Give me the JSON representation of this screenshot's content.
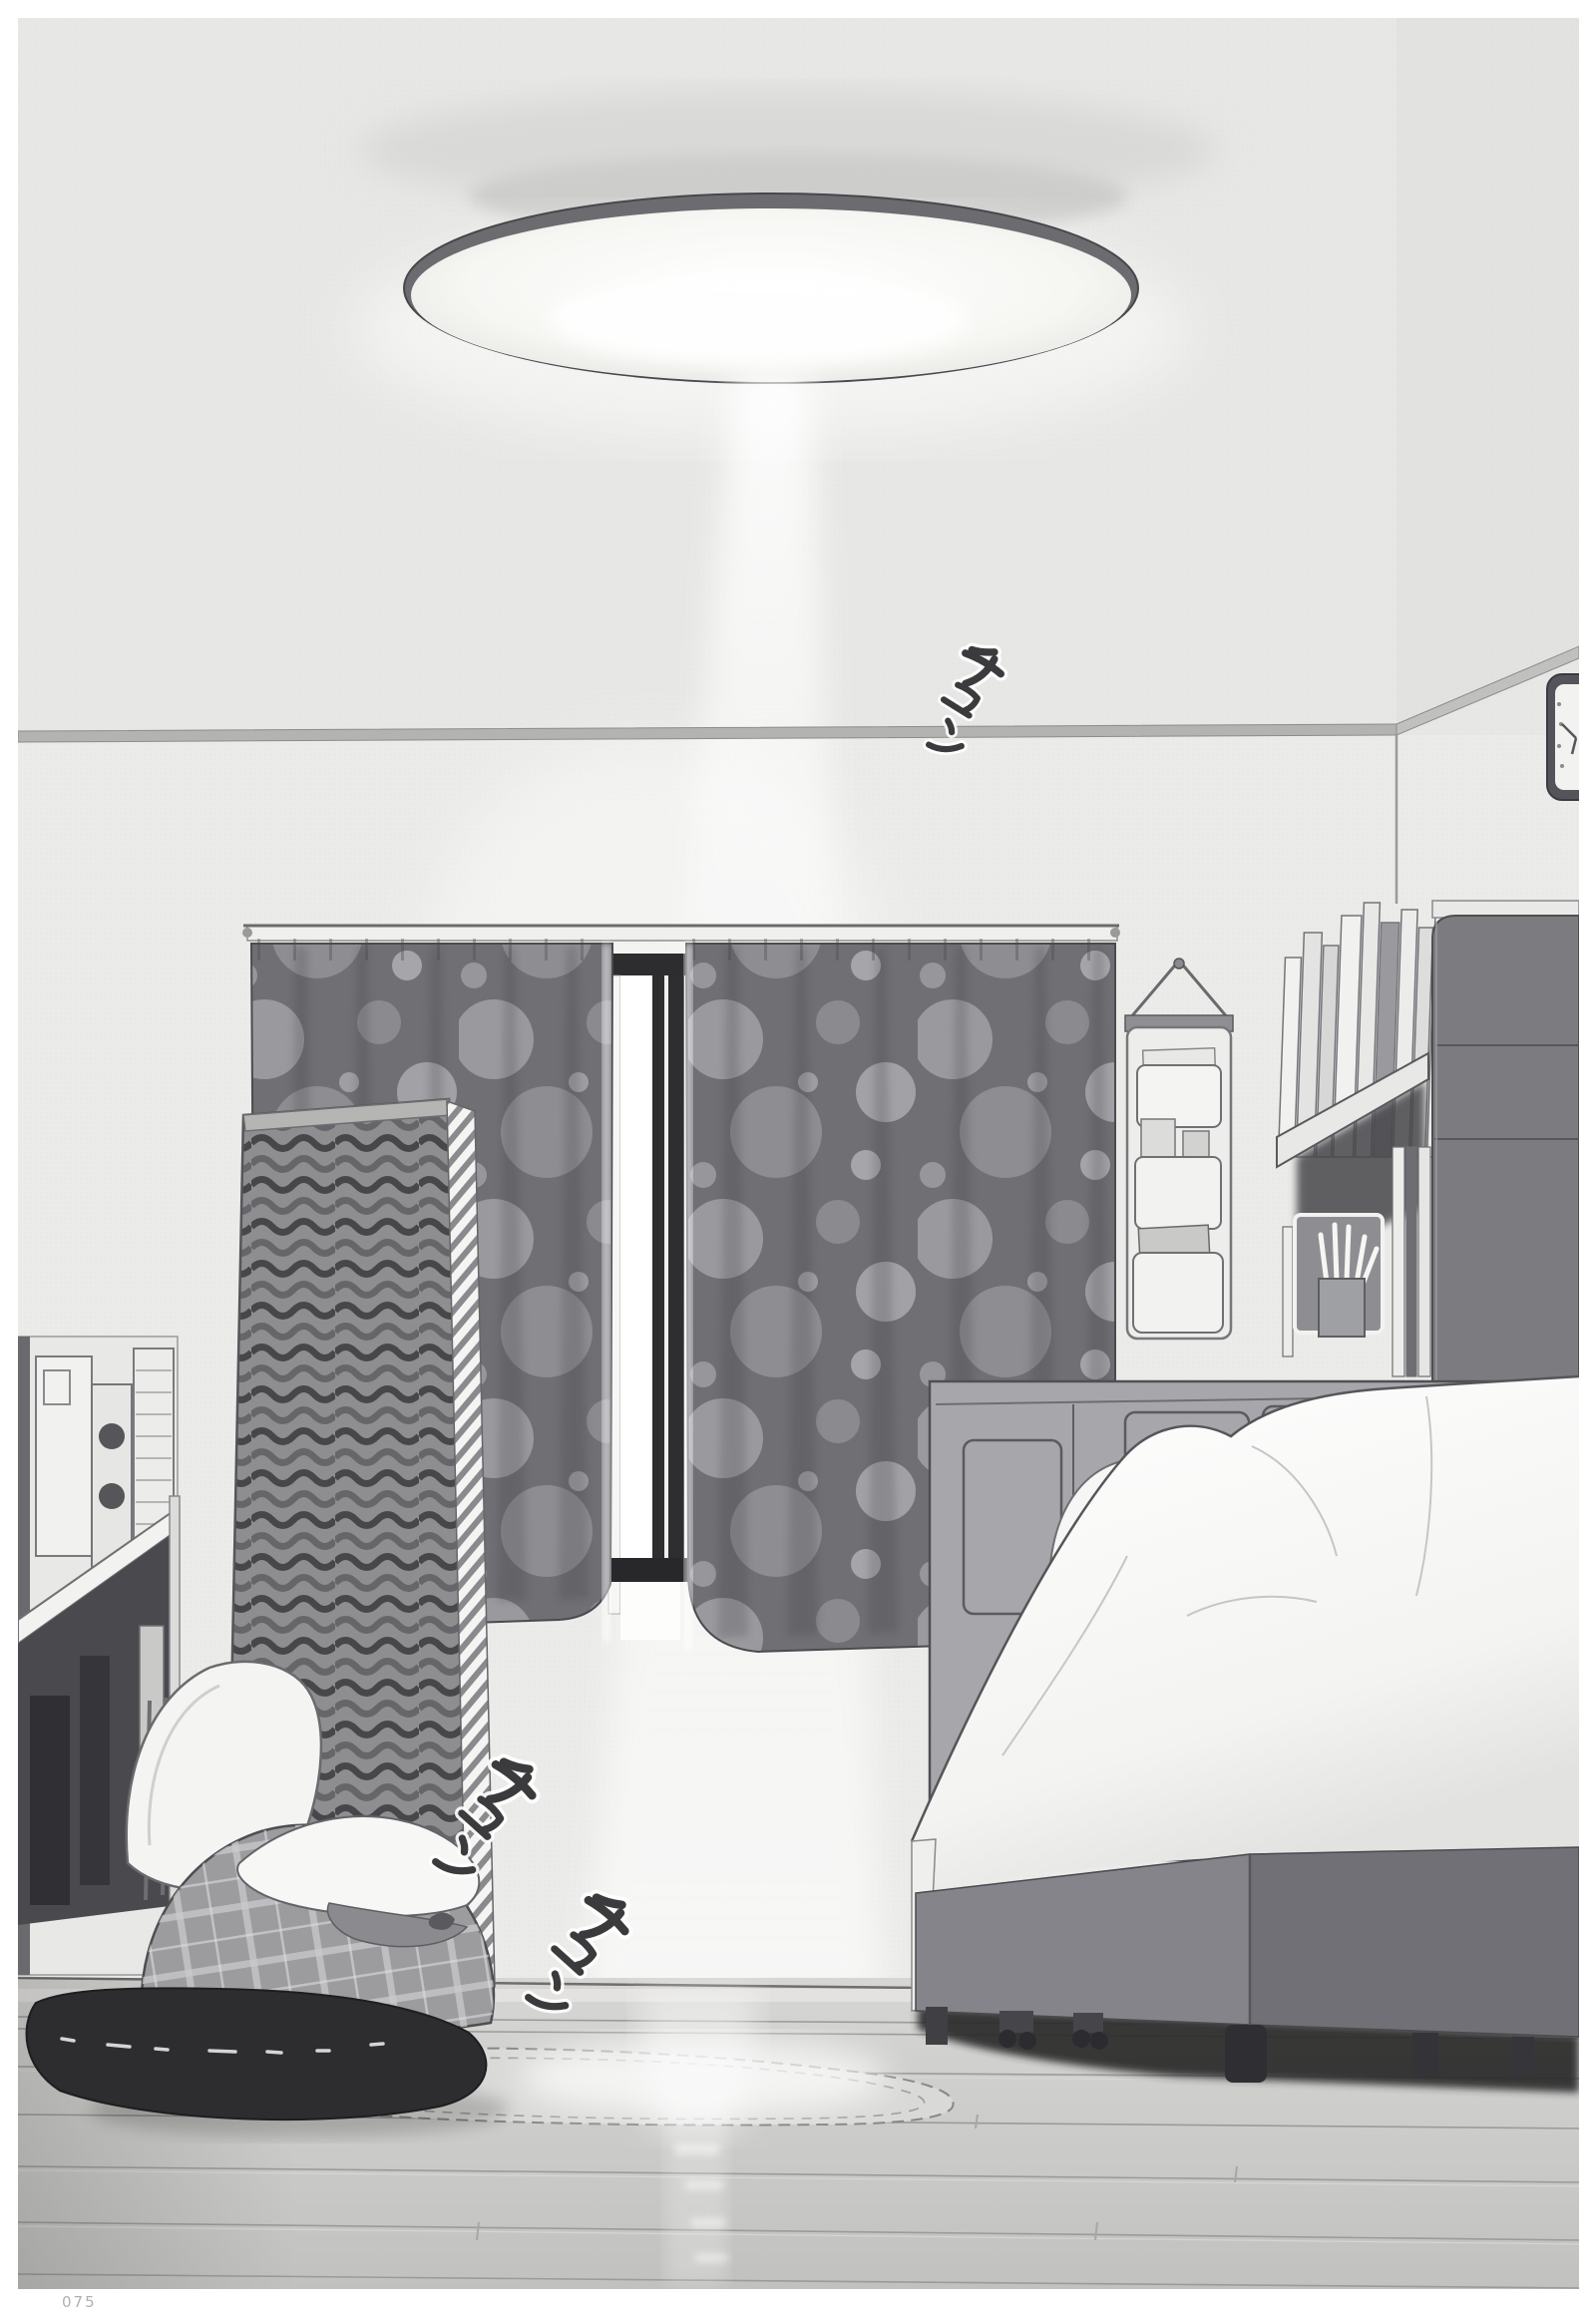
{
  "page": {
    "number": "075"
  },
  "sound_effects": [
    {
      "text": "チュン"
    },
    {
      "text": "チュン"
    },
    {
      "text": "チュン"
    }
  ],
  "palette": {
    "paper_margin": "#ffffff",
    "wall": "#ebebe9",
    "ink_line": "#3a3a3e",
    "curtain_base": "#6f6f74",
    "curtain_dot": "#9c9c9f",
    "towel_wave_dark": "#47474a",
    "bedding_white": "#f8f8f6",
    "bed_base_gray": "#84848a",
    "deep_shadow": "#2a2a2c",
    "floor_gray": "#c8c8c6",
    "page_number_gray": "#b0b0b0"
  }
}
